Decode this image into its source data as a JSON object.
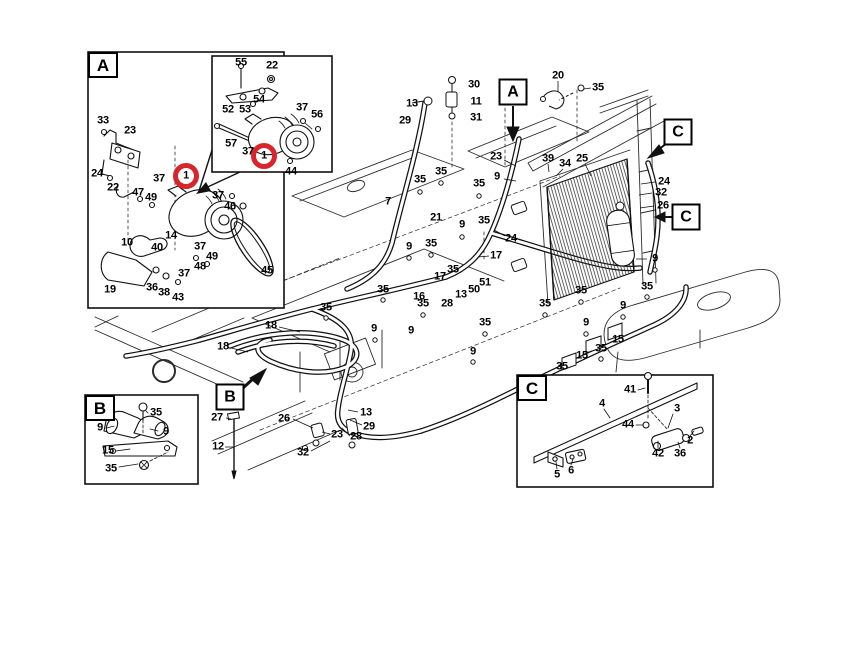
{
  "diagram": {
    "type": "exploded-parts-diagram",
    "colors": {
      "background": "#ffffff",
      "line": "#1a1a1a",
      "highlight_circle": "#d6252b"
    },
    "detail_boxes": [
      {
        "letter": "A",
        "x": 88,
        "y": 52,
        "w": 196,
        "h": 256
      },
      {
        "letter": "B",
        "x": 85,
        "y": 395,
        "w": 113,
        "h": 89
      },
      {
        "letter": "C",
        "x": 517,
        "y": 375,
        "w": 196,
        "h": 112
      },
      {
        "letter": "",
        "x": 212,
        "y": 56,
        "w": 120,
        "h": 116
      }
    ],
    "callouts": [
      {
        "letter": "A",
        "x": 513,
        "y": 92,
        "arrow": "down"
      },
      {
        "letter": "B",
        "x": 230,
        "y": 397,
        "arrow": "up-right"
      },
      {
        "letter": "C",
        "x": 678,
        "y": 132,
        "arrow": "down-left"
      },
      {
        "letter": "C",
        "x": 686,
        "y": 217,
        "arrow": "left"
      }
    ],
    "highlights": [
      {
        "x": 186,
        "y": 176,
        "r": 13
      },
      {
        "x": 264,
        "y": 156,
        "r": 13
      }
    ],
    "part_labels": [
      {
        "t": "33",
        "x": 103,
        "y": 121
      },
      {
        "t": "23",
        "x": 130,
        "y": 131
      },
      {
        "t": "24",
        "x": 97,
        "y": 174
      },
      {
        "t": "22",
        "x": 113,
        "y": 188
      },
      {
        "t": "37",
        "x": 159,
        "y": 179
      },
      {
        "t": "47",
        "x": 138,
        "y": 193
      },
      {
        "t": "49",
        "x": 151,
        "y": 198
      },
      {
        "t": "1",
        "x": 186,
        "y": 176
      },
      {
        "t": "37",
        "x": 218,
        "y": 196
      },
      {
        "t": "46",
        "x": 230,
        "y": 207
      },
      {
        "t": "14",
        "x": 171,
        "y": 236
      },
      {
        "t": "10",
        "x": 127,
        "y": 243
      },
      {
        "t": "40",
        "x": 157,
        "y": 248
      },
      {
        "t": "37",
        "x": 200,
        "y": 247
      },
      {
        "t": "49",
        "x": 212,
        "y": 257
      },
      {
        "t": "48",
        "x": 200,
        "y": 267
      },
      {
        "t": "37",
        "x": 184,
        "y": 274
      },
      {
        "t": "19",
        "x": 110,
        "y": 290
      },
      {
        "t": "36",
        "x": 152,
        "y": 288
      },
      {
        "t": "38",
        "x": 164,
        "y": 293
      },
      {
        "t": "43",
        "x": 178,
        "y": 298
      },
      {
        "t": "45",
        "x": 267,
        "y": 271
      },
      {
        "t": "55",
        "x": 241,
        "y": 63
      },
      {
        "t": "22",
        "x": 272,
        "y": 66
      },
      {
        "t": "54",
        "x": 259,
        "y": 100
      },
      {
        "t": "52",
        "x": 228,
        "y": 110
      },
      {
        "t": "53",
        "x": 245,
        "y": 110
      },
      {
        "t": "37",
        "x": 302,
        "y": 108
      },
      {
        "t": "56",
        "x": 317,
        "y": 115
      },
      {
        "t": "57",
        "x": 231,
        "y": 144
      },
      {
        "t": "37",
        "x": 248,
        "y": 152
      },
      {
        "t": "1",
        "x": 264,
        "y": 156
      },
      {
        "t": "44",
        "x": 291,
        "y": 172
      },
      {
        "t": "13",
        "x": 412,
        "y": 104
      },
      {
        "t": "29",
        "x": 405,
        "y": 121
      },
      {
        "t": "30",
        "x": 474,
        "y": 85
      },
      {
        "t": "11",
        "x": 476,
        "y": 102
      },
      {
        "t": "31",
        "x": 476,
        "y": 118
      },
      {
        "t": "20",
        "x": 558,
        "y": 76
      },
      {
        "t": "35",
        "x": 598,
        "y": 88
      },
      {
        "t": "23",
        "x": 496,
        "y": 157
      },
      {
        "t": "39",
        "x": 548,
        "y": 159
      },
      {
        "t": "34",
        "x": 565,
        "y": 164
      },
      {
        "t": "25",
        "x": 582,
        "y": 159
      },
      {
        "t": "9",
        "x": 497,
        "y": 177
      },
      {
        "t": "35",
        "x": 441,
        "y": 172
      },
      {
        "t": "35",
        "x": 420,
        "y": 180
      },
      {
        "t": "35",
        "x": 479,
        "y": 184
      },
      {
        "t": "7",
        "x": 388,
        "y": 202
      },
      {
        "t": "21",
        "x": 436,
        "y": 218
      },
      {
        "t": "9",
        "x": 462,
        "y": 225
      },
      {
        "t": "35",
        "x": 484,
        "y": 221
      },
      {
        "t": "24",
        "x": 511,
        "y": 239
      },
      {
        "t": "9",
        "x": 409,
        "y": 247
      },
      {
        "t": "35",
        "x": 431,
        "y": 244
      },
      {
        "t": "17",
        "x": 496,
        "y": 256
      },
      {
        "t": "35",
        "x": 453,
        "y": 270
      },
      {
        "t": "17",
        "x": 440,
        "y": 277
      },
      {
        "t": "51",
        "x": 485,
        "y": 283
      },
      {
        "t": "50",
        "x": 474,
        "y": 290
      },
      {
        "t": "13",
        "x": 461,
        "y": 295
      },
      {
        "t": "28",
        "x": 447,
        "y": 304
      },
      {
        "t": "16",
        "x": 419,
        "y": 297
      },
      {
        "t": "35",
        "x": 383,
        "y": 290
      },
      {
        "t": "35",
        "x": 423,
        "y": 304
      },
      {
        "t": "35",
        "x": 326,
        "y": 308
      },
      {
        "t": "9",
        "x": 374,
        "y": 329
      },
      {
        "t": "9",
        "x": 411,
        "y": 331
      },
      {
        "t": "35",
        "x": 485,
        "y": 323
      },
      {
        "t": "9",
        "x": 473,
        "y": 352
      },
      {
        "t": "24",
        "x": 664,
        "y": 182
      },
      {
        "t": "32",
        "x": 661,
        "y": 193
      },
      {
        "t": "26",
        "x": 663,
        "y": 206
      },
      {
        "t": "9",
        "x": 655,
        "y": 259
      },
      {
        "t": "35",
        "x": 647,
        "y": 287
      },
      {
        "t": "9",
        "x": 623,
        "y": 306
      },
      {
        "t": "9",
        "x": 586,
        "y": 323
      },
      {
        "t": "35",
        "x": 581,
        "y": 291
      },
      {
        "t": "35",
        "x": 545,
        "y": 304
      },
      {
        "t": "15",
        "x": 618,
        "y": 340
      },
      {
        "t": "35",
        "x": 601,
        "y": 349
      },
      {
        "t": "15",
        "x": 582,
        "y": 356
      },
      {
        "t": "35",
        "x": 562,
        "y": 367
      },
      {
        "t": "18",
        "x": 271,
        "y": 326
      },
      {
        "t": "18",
        "x": 223,
        "y": 347
      },
      {
        "t": "27",
        "x": 217,
        "y": 418
      },
      {
        "t": "12",
        "x": 218,
        "y": 447
      },
      {
        "t": "26",
        "x": 284,
        "y": 419
      },
      {
        "t": "23",
        "x": 337,
        "y": 435
      },
      {
        "t": "32",
        "x": 303,
        "y": 453
      },
      {
        "t": "13",
        "x": 366,
        "y": 413
      },
      {
        "t": "29",
        "x": 369,
        "y": 427
      },
      {
        "t": "28",
        "x": 356,
        "y": 437
      },
      {
        "t": "35",
        "x": 156,
        "y": 413
      },
      {
        "t": "9",
        "x": 100,
        "y": 428
      },
      {
        "t": "9",
        "x": 166,
        "y": 432
      },
      {
        "t": "15",
        "x": 108,
        "y": 451
      },
      {
        "t": "35",
        "x": 111,
        "y": 469
      },
      {
        "t": "41",
        "x": 630,
        "y": 390
      },
      {
        "t": "4",
        "x": 602,
        "y": 404
      },
      {
        "t": "3",
        "x": 677,
        "y": 409
      },
      {
        "t": "44",
        "x": 628,
        "y": 425
      },
      {
        "t": "2",
        "x": 690,
        "y": 441
      },
      {
        "t": "42",
        "x": 658,
        "y": 454
      },
      {
        "t": "36",
        "x": 680,
        "y": 454
      },
      {
        "t": "6",
        "x": 571,
        "y": 471
      },
      {
        "t": "5",
        "x": 557,
        "y": 475
      }
    ]
  }
}
